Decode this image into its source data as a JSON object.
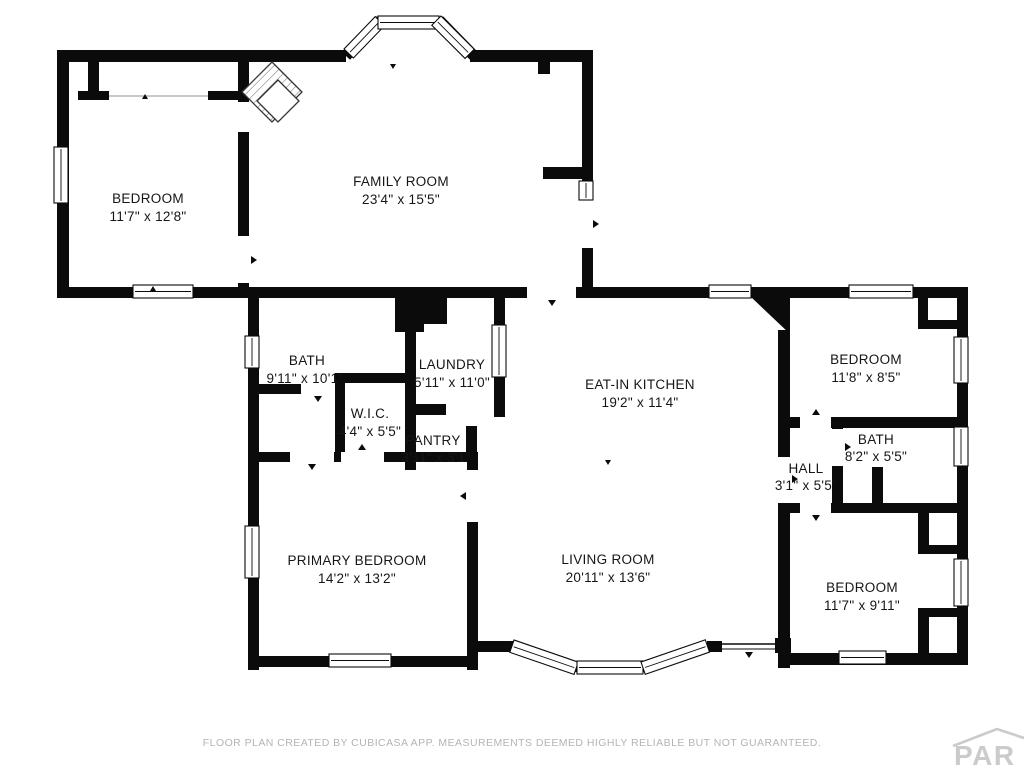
{
  "meta": {
    "type": "floor-plan",
    "background": "#ffffff",
    "wall_color": "#0b0b0b",
    "footer_color": "#b4b4b4",
    "logo_color": "#cbcbcb"
  },
  "rooms": [
    {
      "id": "bedroom-top-left",
      "name": "BEDROOM",
      "dims": "11'7\" x 12'8\""
    },
    {
      "id": "family-room",
      "name": "FAMILY ROOM",
      "dims": "23'4\" x 15'5\""
    },
    {
      "id": "bath-left",
      "name": "BATH",
      "dims": "9'11\" x 10'1\""
    },
    {
      "id": "laundry",
      "name": "LAUNDRY",
      "dims": "5'11\" x 11'0\""
    },
    {
      "id": "walk-in-closet",
      "name": "W.I.C.",
      "dims": "4'4\" x 5'5\""
    },
    {
      "id": "pantry",
      "name": "PANTRY",
      "dims": "3'11\" x 3'1\""
    },
    {
      "id": "eat-in-kitchen",
      "name": "EAT-IN KITCHEN",
      "dims": "19'2\" x 11'4\""
    },
    {
      "id": "bedroom-top-right",
      "name": "BEDROOM",
      "dims": "11'8\" x 8'5\""
    },
    {
      "id": "bath-right",
      "name": "BATH",
      "dims": "8'2\" x 5'5\""
    },
    {
      "id": "hall",
      "name": "HALL",
      "dims": "3'1\" x 5'5\""
    },
    {
      "id": "primary-bedroom",
      "name": "PRIMARY BEDROOM",
      "dims": "14'2\" x 13'2\""
    },
    {
      "id": "living-room",
      "name": "LIVING ROOM",
      "dims": "20'11\" x 13'6\""
    },
    {
      "id": "bedroom-bottom-right",
      "name": "BEDROOM",
      "dims": "11'7\" x 9'11\""
    }
  ],
  "footer": {
    "text": "FLOOR PLAN CREATED BY CUBICASA APP. MEASUREMENTS DEEMED HIGHLY RELIABLE BUT NOT GUARANTEED."
  },
  "logo": {
    "text": "PAR"
  }
}
